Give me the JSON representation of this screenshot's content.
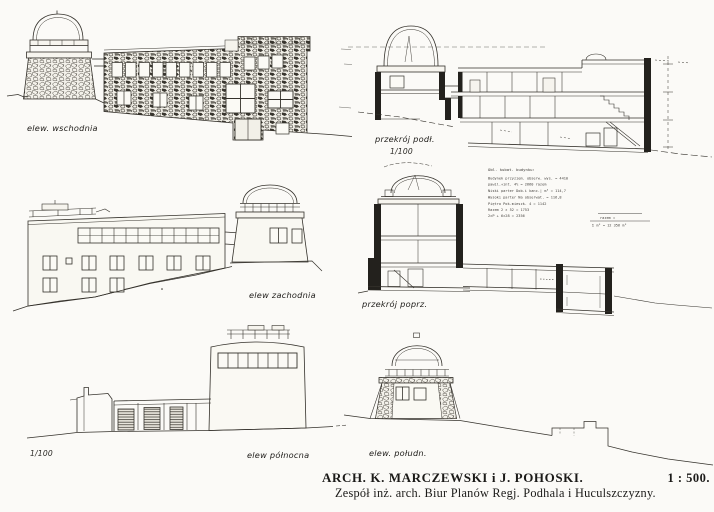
{
  "page": {
    "background": "#fbfaf7",
    "ink": "#2b2925",
    "description": "Scanned sheet of architectural elevations and sections of a mountain observatory"
  },
  "drawings": {
    "east_elevation": {
      "label": "elew. wschodnia"
    },
    "longitudinal_section": {
      "label": "przekrój podł.",
      "scale": "1/100"
    },
    "west_elevation": {
      "label": "elew zachodnia"
    },
    "cross_section": {
      "label": "przekrój poprz."
    },
    "north_elevation": {
      "scale": "1/100",
      "label": "elew północna"
    },
    "south_elevation": {
      "label": "elew. połudn."
    }
  },
  "calc_table": {
    "title": "Obl. kubat. budynku:",
    "rows": [
      "Budynek przyziem.  obserw. wys.      =   4410",
      "                   pawil.+int. 4%    =   2660  razem",
      "Niski parter       Dob.i kanc.| m³   =   114,7",
      "Wysoki parter      Na obserwat.      =   116,8",
      "Piętro             Pok.mieszk. 4     =   1142",
      "                   Razem 2 × 52      =   1753",
      "                   2×P + 6×28        =   2356"
    ],
    "total1": "razem =",
    "total2": "Σ m³ = 12 356 m³"
  },
  "caption": {
    "architects": "ARCH. K. MARCZEWSKI i J. POHOSKI.",
    "scale": "1 : 500.",
    "credit": "Zespół inż. arch. Biur Planów Regj.  Podhala  i  Huculszczyzny."
  }
}
